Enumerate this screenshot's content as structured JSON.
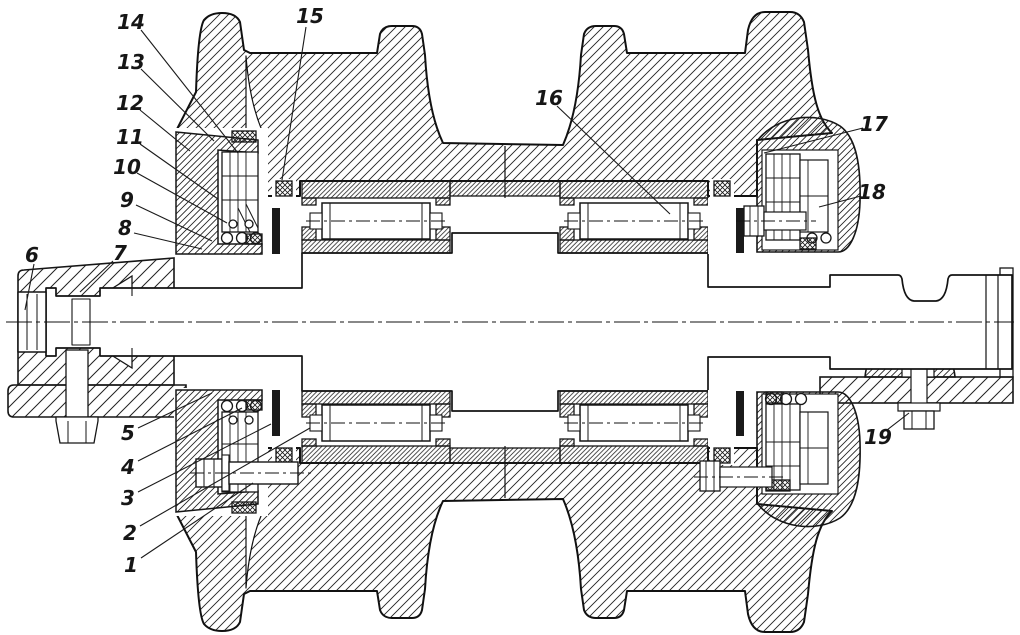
{
  "drawing": {
    "title": "Sectional drawing of double-flanged track support roller",
    "description": "Cross-section: axle with castellated nut, double-flanged roller body, two long cylindrical roller bearings with spacer, spring-loaded face seals with rubber rings and end caps, left clevis bracket with vertical bolt, right bracket plate with bolt.",
    "background_color": "#ffffff",
    "ink_color": "#1a1a1a",
    "callout_count": 19
  },
  "callouts": [
    {
      "label": "1",
      "x": 131,
      "y": 565,
      "line": [
        141,
        558,
        253,
        483
      ]
    },
    {
      "label": "2",
      "x": 130,
      "y": 533,
      "line": [
        140,
        526,
        310,
        428
      ]
    },
    {
      "label": "3",
      "x": 128,
      "y": 498,
      "line": [
        138,
        492,
        271,
        424
      ]
    },
    {
      "label": "4",
      "x": 128,
      "y": 467,
      "line": [
        138,
        461,
        242,
        408
      ]
    },
    {
      "label": "5",
      "x": 128,
      "y": 433,
      "line": [
        138,
        428,
        212,
        393
      ]
    },
    {
      "label": "6",
      "x": 32,
      "y": 255,
      "line": [
        34,
        264,
        25,
        310
      ]
    },
    {
      "label": "7",
      "x": 120,
      "y": 253,
      "line": [
        113,
        261,
        80,
        292
      ]
    },
    {
      "label": "8",
      "x": 125,
      "y": 228,
      "line": [
        134,
        233,
        202,
        249
      ]
    },
    {
      "label": "9",
      "x": 127,
      "y": 200,
      "line": [
        136,
        205,
        212,
        241
      ]
    },
    {
      "label": "10",
      "x": 127,
      "y": 167,
      "line": [
        137,
        173,
        227,
        223
      ]
    },
    {
      "label": "11",
      "x": 130,
      "y": 137,
      "line": [
        140,
        144,
        218,
        199
      ]
    },
    {
      "label": "12",
      "x": 130,
      "y": 103,
      "line": [
        140,
        110,
        190,
        151
      ]
    },
    {
      "label": "13",
      "x": 131,
      "y": 62,
      "line": [
        141,
        69,
        214,
        141
      ]
    },
    {
      "label": "14",
      "x": 131,
      "y": 22,
      "line": [
        141,
        30,
        238,
        153
      ]
    },
    {
      "label": "15",
      "x": 310,
      "y": 16,
      "line": [
        306,
        27,
        282,
        180
      ]
    },
    {
      "label": "16",
      "x": 549,
      "y": 98,
      "line": [
        557,
        106,
        670,
        214
      ]
    },
    {
      "label": "17",
      "x": 874,
      "y": 124,
      "line": [
        863,
        128,
        764,
        153
      ]
    },
    {
      "label": "18",
      "x": 872,
      "y": 192,
      "line": [
        861,
        196,
        819,
        207
      ]
    },
    {
      "label": "19",
      "x": 878,
      "y": 437,
      "line": [
        887,
        430,
        909,
        413
      ]
    }
  ]
}
